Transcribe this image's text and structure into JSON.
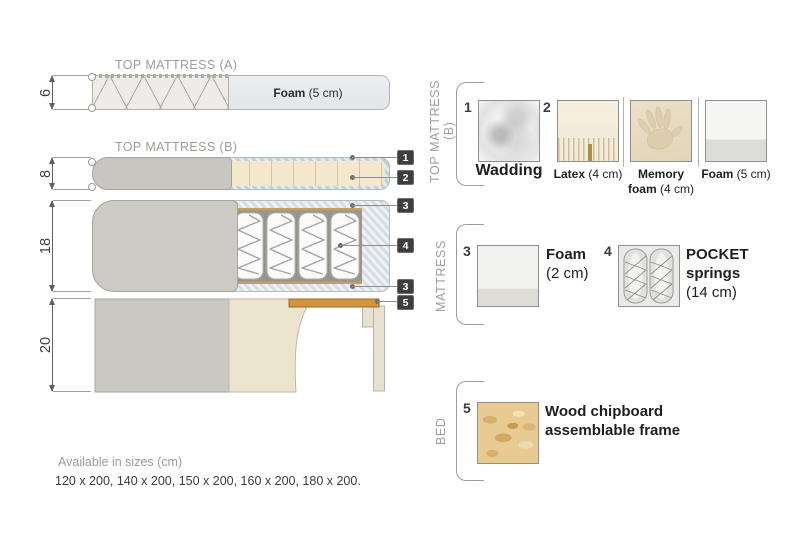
{
  "colors": {
    "wood": "#d2953b",
    "fabric_gray": "#c9c8c3",
    "latex": "#f4e7cd",
    "wadding": "#ccd7df",
    "foam_blue": "#dee4e8",
    "callout_chip": "#3e3e3e"
  },
  "diagram": {
    "top_a": {
      "title": "TOP MATTRESS (A)",
      "height_cm": "6",
      "foam_bold": "Foam",
      "foam_rest": " (5 cm)"
    },
    "top_b": {
      "title": "TOP MATTRESS (B)",
      "height_cm": "8"
    },
    "mattress": {
      "height_cm": "18"
    },
    "bed": {
      "height_cm": "20"
    },
    "callouts": [
      "1",
      "2",
      "3",
      "4",
      "3",
      "5"
    ]
  },
  "legend": {
    "top_b": {
      "label": "TOP MATTRESS (B)",
      "items": [
        {
          "num": "1",
          "bold": "Wadding",
          "rest": ""
        },
        {
          "num": "2",
          "bold": "Latex",
          "rest": " (4 cm)"
        },
        {
          "bold": "Memory",
          "bold2": "foam",
          "rest": " (4 cm)"
        },
        {
          "bold": "Foam",
          "rest": " (5 cm)"
        }
      ]
    },
    "mattress": {
      "label": "MATTRESS",
      "items": [
        {
          "num": "3",
          "bold": "Foam",
          "rest": "(2 cm)"
        },
        {
          "num": "4",
          "bold": "POCKET",
          "bold2": "springs",
          "rest": "(14 cm)"
        }
      ]
    },
    "bed": {
      "label": "BED",
      "items": [
        {
          "num": "5",
          "bold": "Wood chipboard",
          "bold2": "assemblable frame"
        }
      ]
    }
  },
  "footer": {
    "heading": "Available in sizes (cm)",
    "sizes": "120 x 200, 140 x 200, 150 x 200, 160 x 200, 180 x 200."
  }
}
